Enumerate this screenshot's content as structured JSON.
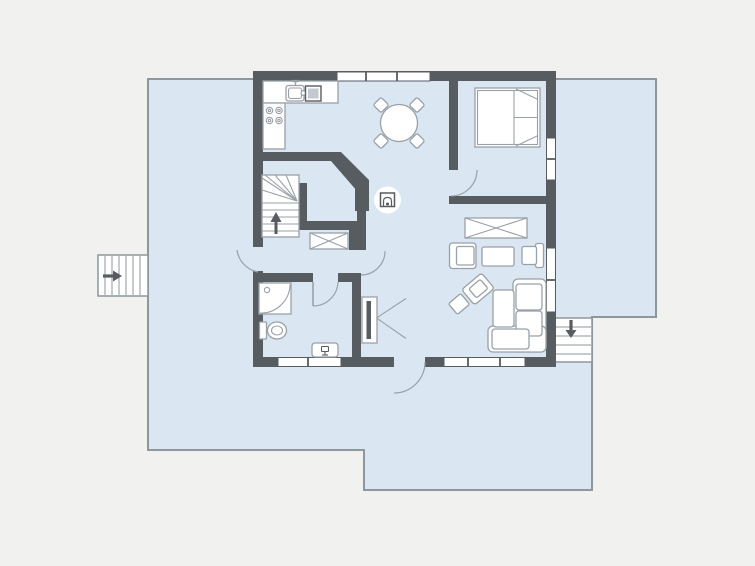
{
  "title": "apartment-floor-plan",
  "colors": {
    "bg": "#f1f1ef",
    "deck": "#dae6f1",
    "deck-border": "#8e979e",
    "floor": "#dae6f1",
    "wall": "#575c61",
    "furn-fill": "#ffffff",
    "furn-stroke": "#99a1a8",
    "icon": "#575c61",
    "appliance": "#c3c9ce"
  },
  "plan": {
    "deck": {
      "name": "terrace-deck",
      "shape": "L-shaped wrap-around"
    },
    "exterior_stairs": [
      {
        "name": "west-entry-stairs",
        "arrow_direction": "right"
      },
      {
        "name": "southeast-stairs",
        "arrow_direction": "down"
      }
    ],
    "rooms": [
      {
        "name": "kitchen",
        "furniture": [
          "counter",
          "sink-unit",
          "cooktop-4-burners"
        ]
      },
      {
        "name": "dining-area",
        "furniture": [
          "round-table",
          "chair-nw",
          "chair-ne",
          "chair-sw",
          "chair-se"
        ]
      },
      {
        "name": "bedroom",
        "furniture": [
          "double-bed"
        ]
      },
      {
        "name": "living-room",
        "furniture": [
          "wardrobe",
          "armchair",
          "coffee-table",
          "side-chair",
          "angled-armchair",
          "stool",
          "corner-sofa",
          "fireplace"
        ]
      },
      {
        "name": "hall",
        "furniture": [
          "interior-staircase-up",
          "wardrobe"
        ]
      },
      {
        "name": "bathroom",
        "furniture": [
          "corner-shower",
          "toilet",
          "washbasin"
        ]
      },
      {
        "name": "corridor",
        "furniture": [
          "open-closet"
        ]
      }
    ],
    "doors": [
      "terrace-door-west",
      "front-door-south",
      "bedroom-door",
      "bathroom-door",
      "hall-living-door"
    ],
    "window_count": 5,
    "interior_stair_arrow": "up",
    "labels": {}
  }
}
